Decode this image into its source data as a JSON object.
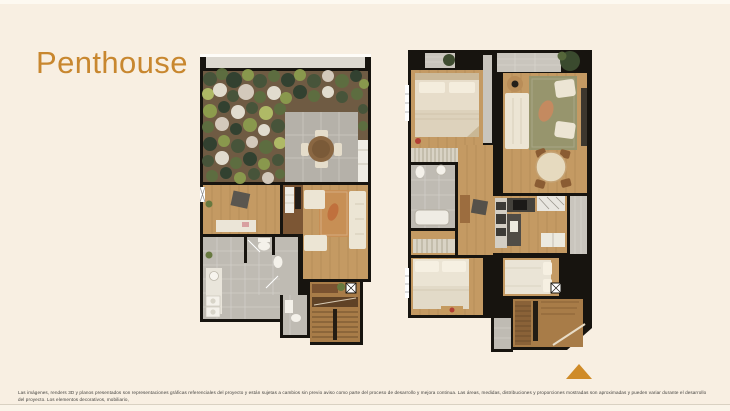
{
  "header": {
    "title": "Penthouse"
  },
  "palette": {
    "background": "#f8efe2",
    "accent_orange": "#c8872f",
    "triangle_orange": "#cf8b28",
    "wall_black": "#17140f",
    "wood_floor": "#c49a63",
    "stair_wood": "#a87c48",
    "tile_gray": "#bfbbb3",
    "patio_stone": "#b5b1a9",
    "garden_green": "#5d6f40",
    "furniture_cream": "#ece5d4",
    "rug_tan": "#c78f55",
    "rug_olive": "#97956d"
  },
  "floorplans": {
    "count": 2
  },
  "footer": {
    "disclaimer_line1": "Las imágenes, renders 3D y planos presentados son representaciones gráficas referenciales del proyecto y están sujetas a cambios sin previo aviso como parte del proceso de desarrollo y mejora continua. Las áreas, medidas, distribuciones y proporciones mostradas son aproximadas y pueden variar durante el desarrollo del proyecto. Los elementos decorativos, mobiliario,",
    "disclaimer_line2": "acabados y equipamiento incluidos en las representaciones son de carácter ilustrativo y no forman parte del producto final, salvo que se indique expresamente en la documentación contractual."
  }
}
